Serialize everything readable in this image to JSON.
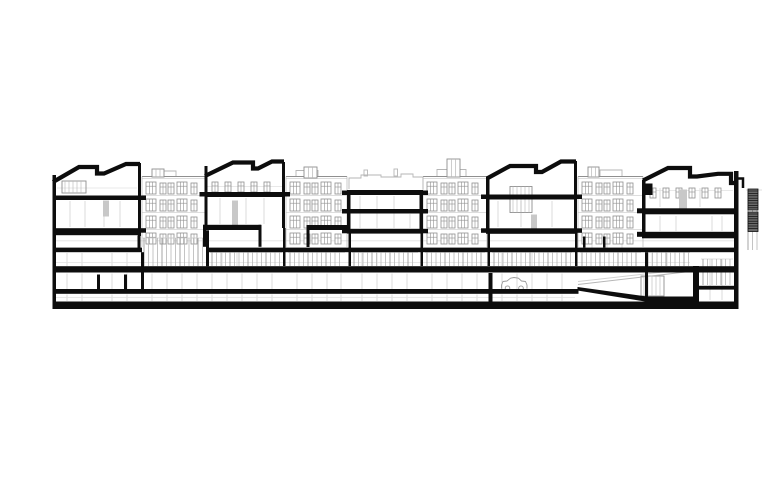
{
  "canvas": {
    "w": 780,
    "h": 488
  },
  "colors": {
    "ink": "#0d0d0d",
    "light": "#8f8f8f",
    "lighter": "#b6b6b6",
    "faint": "#d2d2d2",
    "gray_fill": "#c8c8c8",
    "louver_fill": "#6a6a6a",
    "car": "#9a9a9a",
    "paper": "#ffffff"
  },
  "drawing": {
    "black_rects": [
      [
        52.5,
        175,
        3.5,
        134
      ],
      [
        138,
        163,
        3,
        73
      ],
      [
        204.5,
        166,
        3,
        62
      ],
      [
        282,
        162,
        3,
        66
      ],
      [
        347,
        190,
        3.5,
        42
      ],
      [
        419.5,
        190,
        3.5,
        42
      ],
      [
        486,
        177,
        3.5,
        54
      ],
      [
        574,
        161,
        3,
        70
      ],
      [
        642,
        180,
        3.5,
        55
      ],
      [
        693,
        266,
        6,
        43
      ],
      [
        734,
        171,
        4.5,
        131
      ],
      [
        137.5,
        235.5,
        3,
        12.5
      ],
      [
        141,
        252.2,
        3,
        37
      ],
      [
        206,
        230.3,
        3,
        36
      ],
      [
        283,
        228,
        2.5,
        38
      ],
      [
        348.5,
        232,
        2.5,
        34
      ],
      [
        420.5,
        232,
        2.5,
        34
      ],
      [
        487.5,
        231,
        2.5,
        35
      ],
      [
        488.5,
        273,
        4,
        28.5
      ],
      [
        575,
        231,
        2.5,
        35
      ],
      [
        645,
        252.2,
        3,
        50
      ],
      [
        97,
        274.5,
        3,
        15
      ],
      [
        124,
        274.5,
        3,
        15
      ],
      [
        583,
        236.5,
        2.5,
        11
      ],
      [
        603,
        236.5,
        2.5,
        11
      ],
      [
        55.5,
        195.5,
        83,
        4.5
      ],
      [
        204.5,
        192,
        80,
        5
      ],
      [
        347,
        190,
        76,
        5
      ],
      [
        349,
        209,
        73,
        4.5
      ],
      [
        347,
        228.8,
        76,
        4.8
      ],
      [
        487,
        194.5,
        88,
        5
      ],
      [
        52.5,
        228.2,
        88.5,
        7
      ],
      [
        203,
        224.8,
        58,
        5.2
      ],
      [
        203,
        224.8,
        3,
        22
      ],
      [
        258.5,
        224.8,
        3,
        22
      ],
      [
        306.5,
        225,
        42,
        5
      ],
      [
        306.5,
        225,
        3,
        22
      ],
      [
        486,
        228.3,
        91,
        5.5
      ],
      [
        642,
        208.3,
        94,
        6
      ],
      [
        642,
        231.8,
        95,
        6.5
      ],
      [
        644.5,
        183.5,
        8,
        11.5
      ],
      [
        52.5,
        247.6,
        89.5,
        4.6
      ],
      [
        207,
        247.6,
        531,
        4.6
      ],
      [
        52.5,
        266.2,
        685.5,
        6.3
      ],
      [
        52.5,
        289,
        526,
        4.8
      ],
      [
        52.5,
        301.5,
        686,
        7.5
      ],
      [
        699,
        285.8,
        36,
        3.8
      ],
      [
        141,
        195.5,
        5,
        4.5
      ],
      [
        141,
        228.2,
        5,
        4.5
      ],
      [
        199.5,
        192,
        5,
        4.5
      ],
      [
        285,
        192,
        5,
        4.5
      ],
      [
        342,
        190.5,
        5,
        4.5
      ],
      [
        342,
        209,
        5,
        4.5
      ],
      [
        342,
        228.8,
        5,
        4.5
      ],
      [
        423,
        190.5,
        5,
        4.5
      ],
      [
        423,
        209,
        5,
        4.5
      ],
      [
        423,
        228.8,
        5,
        4.5
      ],
      [
        481,
        194.5,
        5,
        4.5
      ],
      [
        481,
        228.3,
        5,
        4.5
      ],
      [
        577,
        194.5,
        5,
        4.5
      ],
      [
        577,
        228.3,
        5,
        4.5
      ],
      [
        637,
        208.3,
        5,
        5
      ],
      [
        637,
        231.8,
        5,
        5
      ]
    ],
    "roof_paths": [
      {
        "name": "roof-block-a",
        "w": 4.2,
        "pts": [
          [
            53,
            182
          ],
          [
            79,
            167
          ],
          [
            97,
            167
          ],
          [
            97,
            173.5
          ],
          [
            104,
            173.5
          ],
          [
            126,
            164
          ],
          [
            140,
            164
          ]
        ]
      },
      {
        "name": "roof-block-b",
        "w": 4.2,
        "pts": [
          [
            205,
            176
          ],
          [
            233,
            162.5
          ],
          [
            253,
            162.5
          ],
          [
            253,
            168.5
          ],
          [
            258,
            168.5
          ],
          [
            272,
            161.5
          ],
          [
            284,
            161.5
          ]
        ]
      },
      {
        "name": "roof-block-d",
        "w": 4.2,
        "pts": [
          [
            487,
            178.5
          ],
          [
            510,
            166
          ],
          [
            536,
            166
          ],
          [
            536,
            172
          ],
          [
            542,
            172
          ],
          [
            561,
            161.5
          ],
          [
            576,
            161.5
          ]
        ]
      },
      {
        "name": "roof-block-e",
        "w": 4.2,
        "pts": [
          [
            643,
            180.5
          ],
          [
            668,
            168
          ],
          [
            690,
            168
          ],
          [
            690,
            176.5
          ],
          [
            697,
            176.5
          ],
          [
            718,
            173.8
          ],
          [
            731,
            173.8
          ],
          [
            731,
            183
          ],
          [
            737,
            183
          ]
        ]
      },
      {
        "name": "roof-parapet-hook",
        "w": 2.5,
        "pts": [
          [
            737,
            188
          ],
          [
            737,
            178.5
          ],
          [
            743,
            178.5
          ],
          [
            743,
            188
          ]
        ]
      }
    ],
    "facade_rows": [
      {
        "y": 182,
        "h": 12
      },
      {
        "y": 199,
        "h": 12
      },
      {
        "y": 216,
        "h": 12
      },
      {
        "y": 233,
        "h": 11
      }
    ],
    "facades": [
      {
        "name": "facade-1",
        "x0": 142,
        "x1": 207
      },
      {
        "name": "facade-2",
        "x0": 286,
        "x1": 347
      },
      {
        "name": "facade-3",
        "x0": 423,
        "x1": 487
      },
      {
        "name": "facade-4",
        "x0": 578,
        "x1": 643
      }
    ],
    "window_strips": [
      {
        "x0": 212,
        "x1": 281,
        "y": 182,
        "h": 10,
        "pitch": 13
      },
      {
        "x0": 650,
        "x1": 730,
        "y": 188,
        "h": 10,
        "pitch": 13
      }
    ],
    "storefronts": [
      {
        "x0": 142,
        "x1": 207,
        "y0": 238,
        "y1": 266
      },
      {
        "x0": 210,
        "x1": 282,
        "y0": 252.5,
        "y1": 266
      },
      {
        "x0": 288,
        "x1": 345,
        "y0": 252.5,
        "y1": 266
      },
      {
        "x0": 352,
        "x1": 418,
        "y0": 252.5,
        "y1": 266
      },
      {
        "x0": 425,
        "x1": 485,
        "y0": 252.5,
        "y1": 266
      },
      {
        "x0": 492,
        "x1": 572,
        "y0": 252.5,
        "y1": 266
      },
      {
        "x0": 580,
        "x1": 641,
        "y0": 252.5,
        "y1": 266
      },
      {
        "x0": 646,
        "x1": 690,
        "y0": 252.5,
        "y1": 266
      },
      {
        "x0": 701,
        "x1": 733,
        "y0": 259,
        "y1": 285
      },
      {
        "x0": 746,
        "x1": 762,
        "y0": 190,
        "y1": 250
      }
    ],
    "bulkheads": [
      [
        152,
        169,
        12,
        8
      ],
      [
        304,
        167,
        13,
        11
      ],
      [
        447,
        159,
        13,
        18
      ],
      [
        588,
        167,
        11,
        10
      ]
    ],
    "rooflines": [
      [
        [
          349,
          189
        ],
        [
          349,
          178
        ],
        [
          361,
          178
        ],
        [
          361,
          175
        ],
        [
          381,
          175
        ],
        [
          381,
          177
        ],
        [
          401,
          177
        ],
        [
          401,
          174
        ],
        [
          413,
          174
        ],
        [
          413,
          177
        ],
        [
          423,
          177
        ],
        [
          423,
          189
        ]
      ],
      [
        [
          286,
          176.5
        ],
        [
          296,
          176.5
        ],
        [
          296,
          170.5
        ],
        [
          318,
          170.5
        ],
        [
          318,
          176.5
        ]
      ],
      [
        [
          425,
          176.5
        ],
        [
          437,
          176.5
        ],
        [
          437,
          169.5
        ],
        [
          466,
          169.5
        ],
        [
          466,
          176.5
        ]
      ],
      [
        [
          144,
          176.5
        ],
        [
          160,
          176.5
        ],
        [
          160,
          171
        ],
        [
          176,
          171
        ],
        [
          176,
          176.5
        ]
      ],
      [
        [
          580,
          176.5
        ],
        [
          600,
          176.5
        ],
        [
          600,
          170
        ],
        [
          622,
          170
        ],
        [
          622,
          176.5
        ]
      ]
    ],
    "chimneys": [
      [
        364,
        170,
        3.5,
        6
      ],
      [
        394,
        169,
        3.5,
        7
      ]
    ],
    "facade_top_y": 176.5,
    "gray_rects": [
      [
        103,
        200.5,
        6,
        16
      ],
      [
        232,
        200.5,
        6,
        26
      ],
      [
        531,
        214.5,
        6,
        17
      ],
      [
        679,
        189.5,
        8,
        19
      ]
    ],
    "light_boxes": [
      [
        62,
        181,
        24,
        12
      ],
      [
        510,
        186.5,
        22,
        26
      ],
      [
        641,
        276,
        23,
        20
      ]
    ],
    "louvers": [
      [
        748,
        189,
        10,
        21
      ],
      [
        748,
        212,
        10,
        19.5
      ]
    ],
    "car": {
      "x0": 501.5,
      "x1": 527,
      "top": 277.5,
      "bottom": 288.6,
      "wheel_r": 2.3,
      "wheel_y": 288.2,
      "wx1": 507.5,
      "wx2": 521
    },
    "ramp": {
      "wedge": [
        [
          577.5,
          287
        ],
        [
          647,
          296.5
        ],
        [
          694,
          296.5
        ],
        [
          694,
          301.5
        ],
        [
          645,
          301.5
        ],
        [
          577.5,
          290.5
        ]
      ],
      "rails": [
        [
          578,
          284.5,
          694,
          271
        ],
        [
          578,
          281.5,
          694,
          268.5
        ]
      ]
    },
    "faint_v_cols": {
      "xs": [
        67,
        82,
        112,
        127,
        152,
        167,
        182,
        197,
        212,
        227,
        242,
        257,
        272,
        297,
        312,
        327,
        341,
        362,
        377,
        392,
        407,
        432,
        447,
        462,
        477,
        502,
        517,
        532,
        547,
        562
      ],
      "y1": 273.5,
      "y2": 289,
      "y3": 294.5,
      "y4": 301
    },
    "faint_v_upper": [
      [
        67,
        253,
        266
      ],
      [
        82,
        253,
        266
      ],
      [
        112,
        253,
        266
      ],
      [
        127,
        253,
        266
      ],
      [
        222,
        253,
        266
      ],
      [
        237,
        253,
        266
      ],
      [
        362,
        253,
        266
      ],
      [
        377,
        253,
        266
      ],
      [
        502,
        253,
        266
      ],
      [
        532,
        253,
        266
      ],
      [
        652,
        253,
        266
      ],
      [
        667,
        253,
        266
      ],
      [
        592,
        237,
        247.5
      ],
      [
        607,
        237,
        247.5
      ],
      [
        622,
        237,
        247.5
      ],
      [
        70,
        201,
        227
      ],
      [
        85,
        201,
        227
      ],
      [
        104,
        216,
        227
      ],
      [
        120,
        201,
        227
      ],
      [
        220,
        198,
        224
      ],
      [
        246,
        198,
        224
      ],
      [
        264,
        198,
        224
      ],
      [
        360,
        196,
        228
      ],
      [
        377,
        196,
        228
      ],
      [
        394,
        196,
        228
      ],
      [
        410,
        214,
        228
      ],
      [
        498,
        201,
        227
      ],
      [
        521,
        201,
        227
      ],
      [
        552,
        201,
        227
      ],
      [
        660,
        216,
        231
      ],
      [
        676,
        216,
        231
      ],
      [
        712,
        216,
        231
      ],
      [
        722,
        216,
        231
      ],
      [
        660,
        188,
        207
      ],
      [
        700,
        188,
        207
      ],
      [
        710,
        259,
        300
      ],
      [
        722,
        259,
        300
      ]
    ],
    "faint_h": [
      [
        240.8,
        55,
        737
      ],
      [
        262.5,
        55,
        690
      ],
      [
        297.5,
        55,
        575
      ],
      [
        188,
        57,
        137
      ],
      [
        186.5,
        206,
        282
      ],
      [
        190.5,
        646,
        733
      ]
    ]
  }
}
